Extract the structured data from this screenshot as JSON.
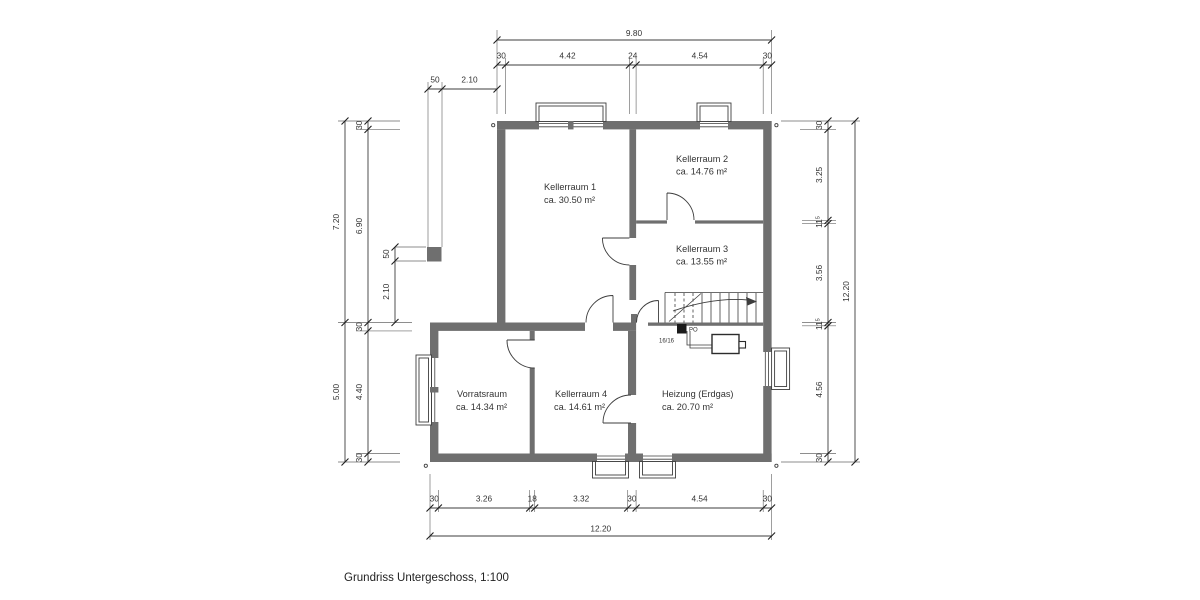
{
  "title": "Grundriss Untergeschoss, 1:100",
  "rooms": [
    {
      "name": "Kellerraum 1",
      "area": "ca. 30.50 m²"
    },
    {
      "name": "Kellerraum 2",
      "area": "ca. 14.76 m²"
    },
    {
      "name": "Kellerraum 3",
      "area": "ca. 13.55 m²"
    },
    {
      "name": "Vorratsraum",
      "area": "ca. 14.34 m²"
    },
    {
      "name": "Kellerraum 4",
      "area": "ca. 14.61 m²"
    },
    {
      "name": "Heizung (Erdgas)",
      "area": "ca. 20.70 m²"
    }
  ],
  "dims": {
    "top_total": "9.80",
    "top": [
      "30",
      "4.42",
      "24",
      "4.54",
      "30"
    ],
    "top_left": [
      "50",
      "2.10"
    ],
    "left_outer": [
      "7.20",
      "5.00"
    ],
    "left_inner": [
      "30",
      "6.90",
      "30",
      "4.40",
      "30"
    ],
    "left_small": [
      "50",
      "2.10"
    ],
    "right_total": "12.20",
    "right_inner": [
      "30",
      "3.25",
      "11",
      "3.56",
      "11",
      "4.56",
      "30"
    ],
    "right_sup": "5",
    "bottom_total": "12.20",
    "bottom": [
      "30",
      "3.26",
      "18",
      "3.32",
      "30",
      "4.54",
      "30"
    ]
  },
  "annotations": {
    "column_label": "PO",
    "column_size": "16/16"
  },
  "colors": {
    "wall": "#6f6f6f",
    "line": "#3d3d3d",
    "text": "#333333"
  }
}
